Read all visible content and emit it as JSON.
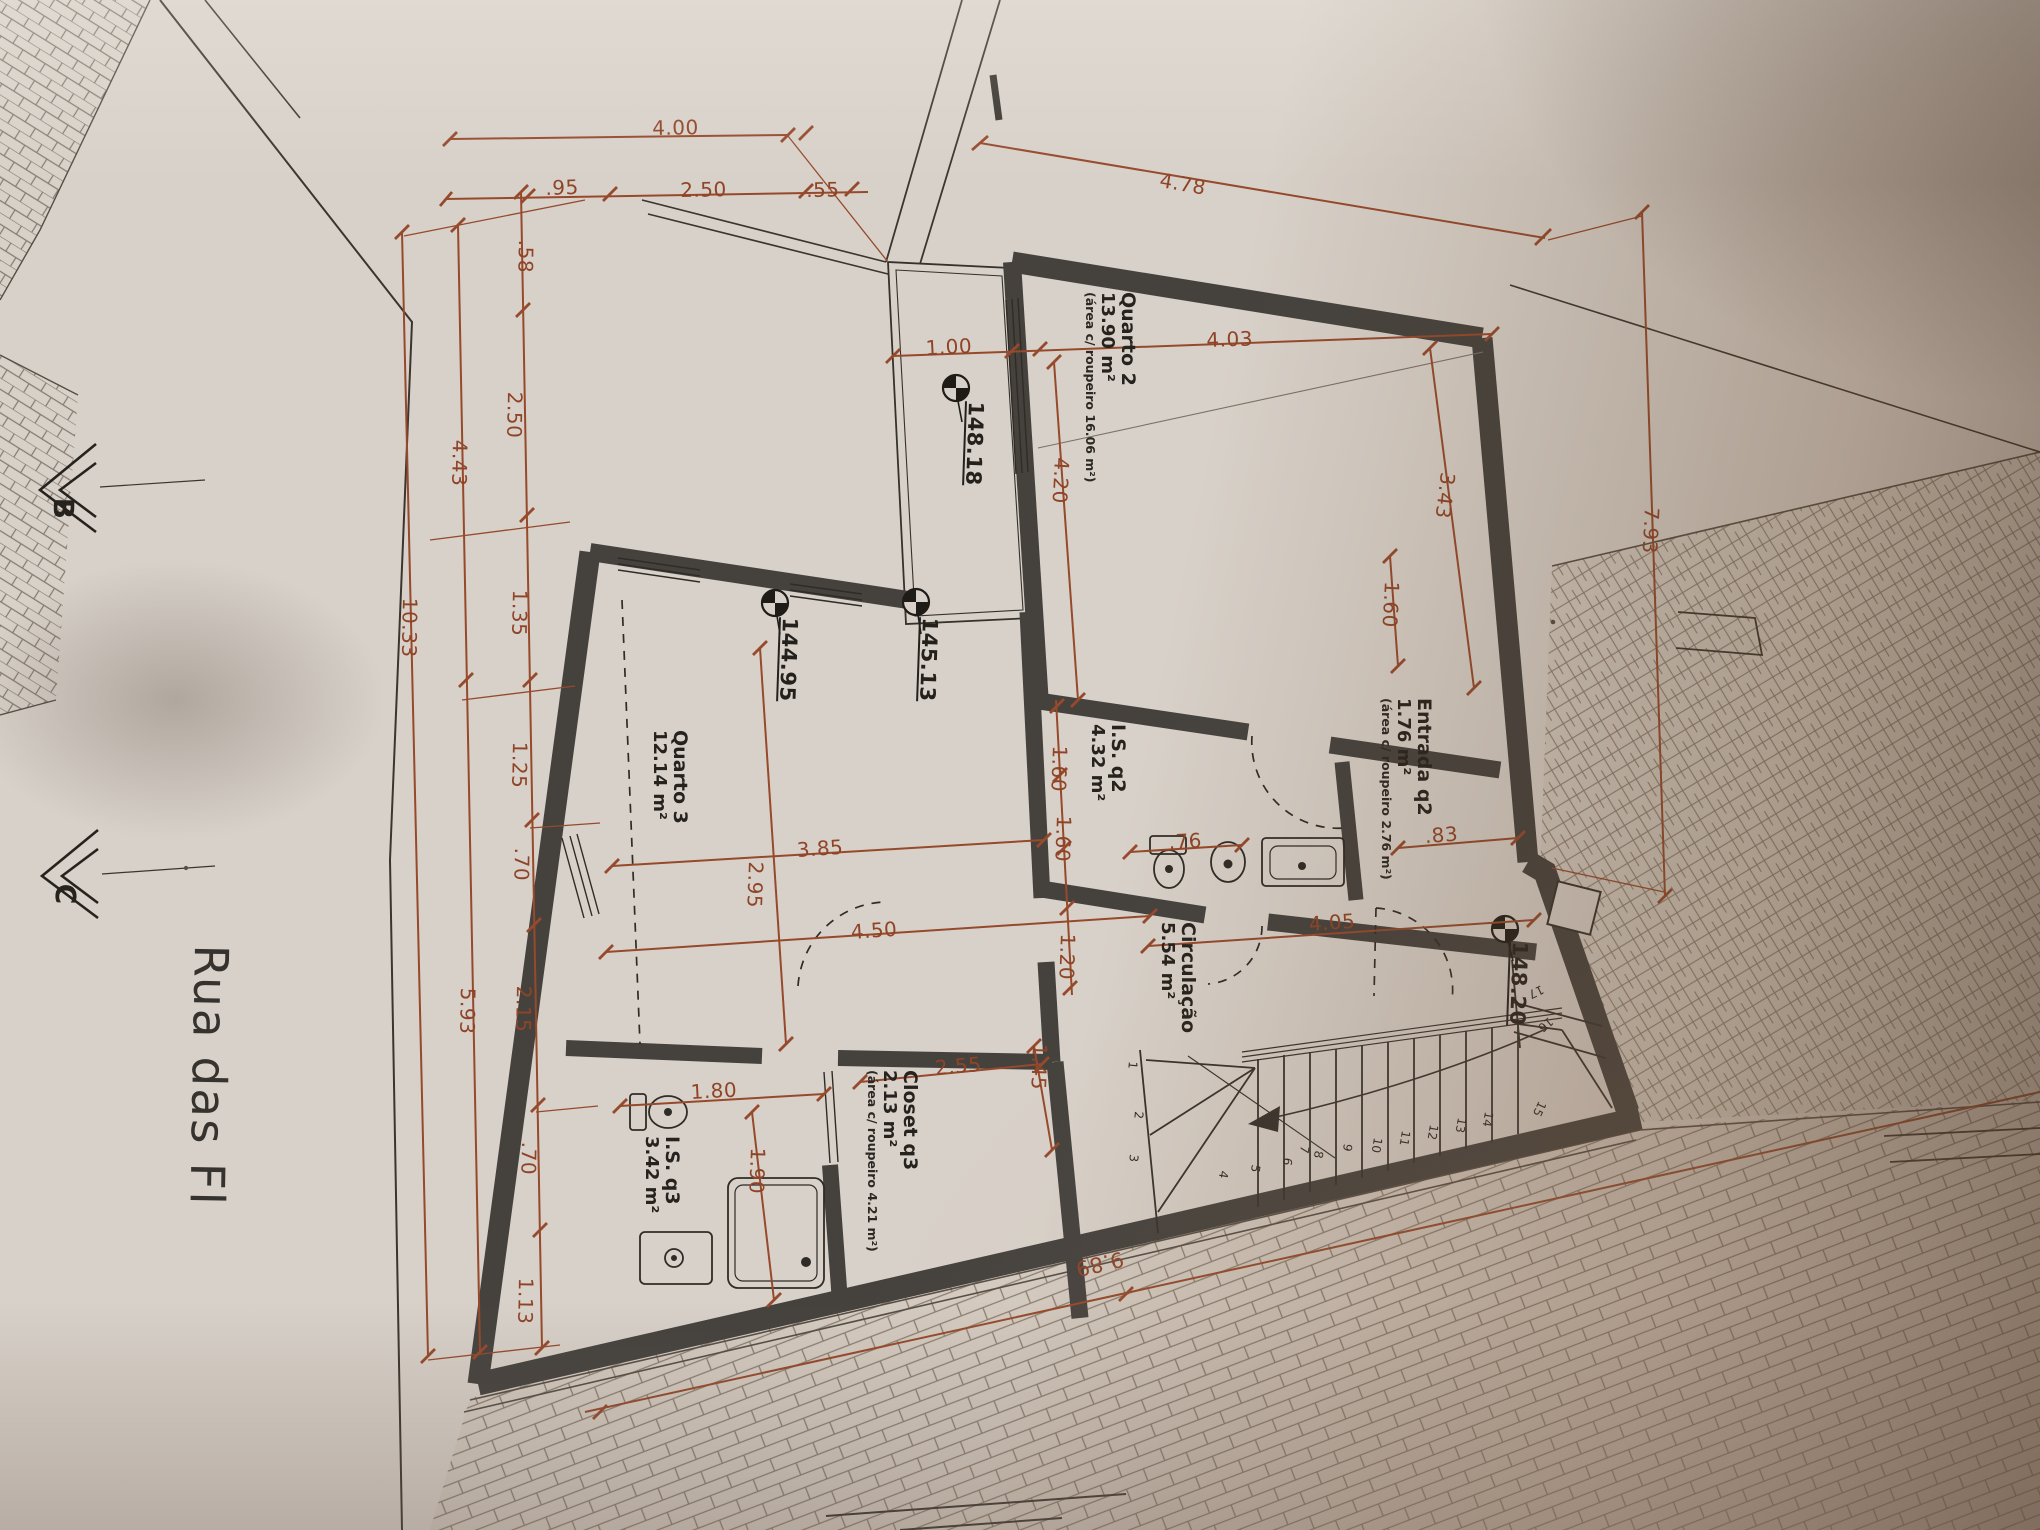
{
  "drawing": {
    "kind": "architectural floor plan (photographed, rotated 90°)",
    "street": {
      "label": "Rua das Fl"
    },
    "sections": {
      "b": "B",
      "c": "C"
    }
  },
  "colors": {
    "paper": "#d8d1c9",
    "wall": "#45423e",
    "ink": "#2c2823",
    "dimension_red": "#96492b"
  },
  "rooms": {
    "quarto2": {
      "name": "Quarto 2",
      "area": "13.90 m²",
      "note": "(área c/ roupeiro 16.06 m²)"
    },
    "entrada_q2": {
      "name": "Entrada q2",
      "area": "1.76 m²",
      "note": "(área c/ roupeiro 2.76 m²)"
    },
    "is_q2": {
      "name": "I.S. q2",
      "area": "4.32 m²"
    },
    "circulacao": {
      "name": "Circulação",
      "area": "5.54 m²"
    },
    "quarto3": {
      "name": "Quarto 3",
      "area": "12.14 m²"
    },
    "is_q3": {
      "name": "I.S. q3",
      "area": "3.42 m²"
    },
    "closet_q3": {
      "name": "Closet q3",
      "area": "2.13 m²",
      "note": "(área c/ roupeiro 4.21 m²)"
    }
  },
  "levels": [
    "148.18",
    "145.13",
    "144.95",
    "148.20"
  ],
  "dims": [
    "4.00",
    ".95",
    "2.50",
    ".55",
    "4.78",
    ".58",
    "2.50",
    "1.35",
    "1.25",
    ".70",
    "2.15",
    ".70",
    "1.13",
    "4.43",
    "5.93",
    "10.33",
    "1.00",
    "4.03",
    "4.20",
    "3.43",
    "1.60",
    ".83",
    "1.60",
    "1.60",
    "1.20",
    ".76",
    "4.05",
    "3.85",
    "2.95",
    "4.50",
    "1.80",
    "1.90",
    "2.55",
    "1.45",
    "7.93",
    "9.89"
  ],
  "stairs": {
    "steps": [
      "1",
      "2",
      "3",
      "4",
      "5",
      "6",
      "7",
      "8",
      "9",
      "10",
      "11",
      "12",
      "13",
      "14",
      "15",
      "16",
      "17"
    ]
  }
}
